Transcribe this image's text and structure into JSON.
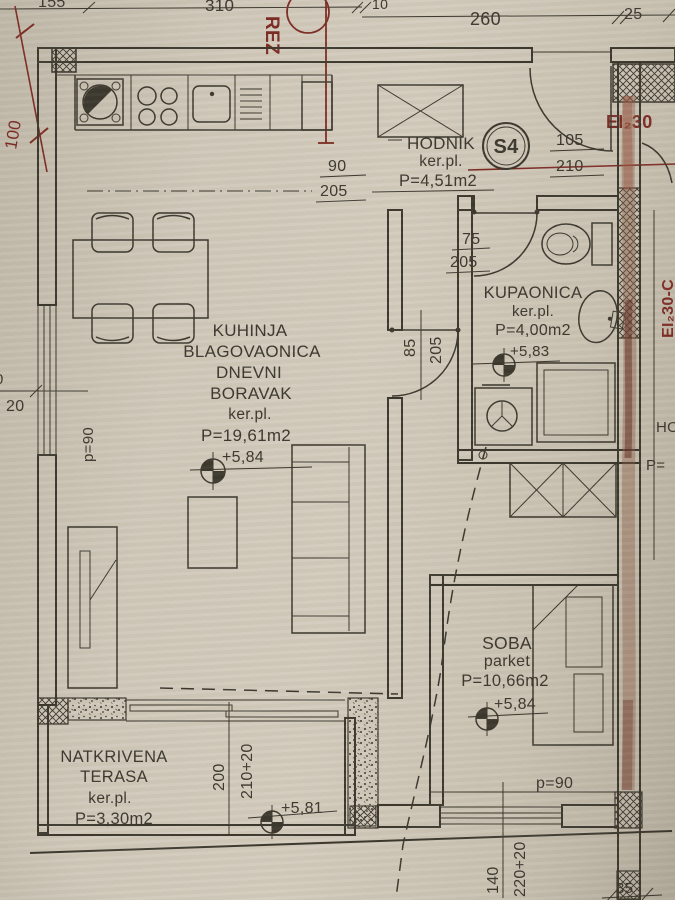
{
  "colors": {
    "paper": "#cfc7b8",
    "ink": "#3a362c",
    "red": "#7c2a22",
    "wall_streak": "#7a4a3a"
  },
  "top_dims": {
    "d155": "155",
    "d310": "310",
    "d10": "10",
    "d260": "260",
    "d25": "25"
  },
  "left_dims": {
    "d100": "100",
    "frag0": "0",
    "d20": "20",
    "parapet": "p=90"
  },
  "section": {
    "label": "REZ"
  },
  "fire_rating": {
    "horizontal": "EI₂30",
    "vertical": "EI₂30-C"
  },
  "hodnik": {
    "name": "HODNIK",
    "floor": "ker.pl.",
    "area": "P=4,51m2",
    "tag": "S4",
    "entry_door": {
      "w": "105",
      "h": "210"
    },
    "kitchen_door": {
      "w": "90",
      "h": "205"
    }
  },
  "kupaonica": {
    "name": "KUPAONICA",
    "floor": "ker.pl.",
    "area": "P=4,00m2",
    "level": "+5,83",
    "door": {
      "w": "75",
      "h": "205"
    }
  },
  "living": {
    "name1": "KUHINJA",
    "name2": "BLAGOVAONICA",
    "name3": "DNEVNI",
    "name4": "BORAVAK",
    "floor": "ker.pl.",
    "area": "P=19,61m2",
    "level": "+5,84",
    "door": {
      "w": "85",
      "h": "205"
    }
  },
  "soba": {
    "name": "SOBA",
    "floor": "parket",
    "area": "P=10,66m2",
    "level": "+5,84",
    "parapet": "p=90",
    "window": {
      "w": "140",
      "h": "220+20"
    },
    "dim_right": "35"
  },
  "terasa": {
    "name1": "NATKRIVENA",
    "name2": "TERASA",
    "floor": "ker.pl.",
    "area": "P=3,30m2",
    "level": "+5,81",
    "door": {
      "w": "200",
      "h": "210+20"
    }
  },
  "neighbor": {
    "frag1": "HO",
    "frag2": "P="
  }
}
